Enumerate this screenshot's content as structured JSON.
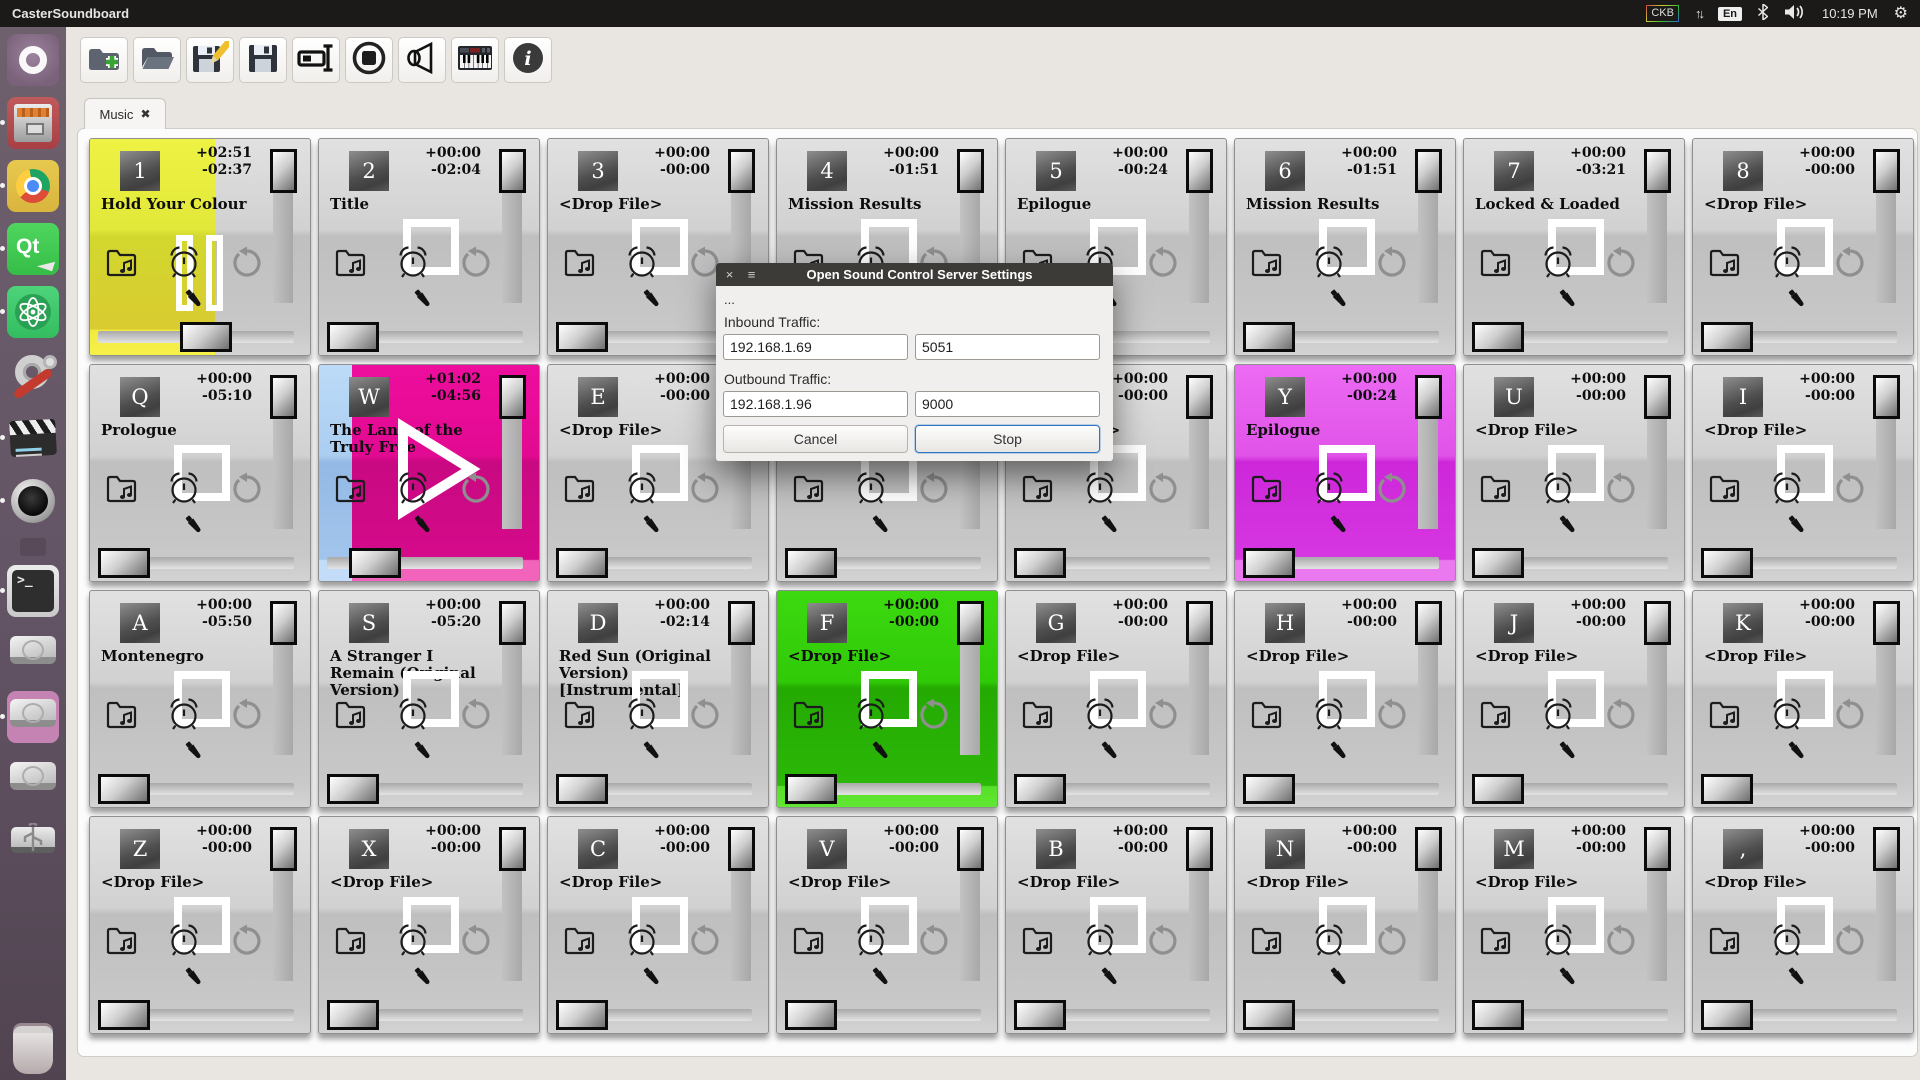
{
  "topbar": {
    "app_title": "CasterSoundboard",
    "kbd_badge": "CKB",
    "lang_badge": "En",
    "clock": "10:19 PM"
  },
  "launcher": {
    "items": [
      {
        "name": "ubuntu-dash",
        "dot": false
      },
      {
        "name": "file-cabinet",
        "dot": true
      },
      {
        "name": "chrome-browser",
        "dot": true
      },
      {
        "name": "qt-creator",
        "dot": true
      },
      {
        "name": "atom-editor",
        "dot": true
      },
      {
        "name": "system-tools",
        "dot": false
      },
      {
        "name": "video-editor",
        "dot": true
      },
      {
        "name": "speaker-app",
        "dot": true
      },
      {
        "name": "mini-indicator",
        "dot": false
      },
      {
        "name": "terminal",
        "dot": true
      },
      {
        "name": "hard-drive-1",
        "dot": false
      },
      {
        "name": "hard-drive-mounted",
        "dot": true
      },
      {
        "name": "hard-drive-2",
        "dot": false
      },
      {
        "name": "usb-drive",
        "dot": false
      },
      {
        "name": "trash",
        "dot": false
      }
    ]
  },
  "toolbar": {
    "buttons": [
      {
        "name": "new-soundboard"
      },
      {
        "name": "open-soundboard"
      },
      {
        "name": "save-soundboard-as"
      },
      {
        "name": "save-soundboard"
      },
      {
        "name": "rename-board"
      },
      {
        "name": "stop-all-sounds"
      },
      {
        "name": "audio-output"
      },
      {
        "name": "midi-keyboard"
      },
      {
        "name": "about-info"
      }
    ]
  },
  "tabbar": {
    "tabs": [
      {
        "label": "Music",
        "close_glyph": "✖"
      }
    ]
  },
  "colors": {
    "pad_yellow": "#e8ee3a",
    "pad_magenta": "#e0098e",
    "pad_violet": "#d93ae3",
    "pad_green": "#2ec607",
    "fill_blue": "#a9cbf0",
    "dialog_titlebar": "#3c3b37",
    "accent_blue": "#2f76c0"
  },
  "board": {
    "pads": [
      {
        "key": "1",
        "title": "Hold Your Colour",
        "elapsed": "+02:51",
        "remaining": "-02:37",
        "state": "pause",
        "base": "gray",
        "fill": "yellow",
        "fill_pct": 57
      },
      {
        "key": "2",
        "title": "Title",
        "elapsed": "+00:00",
        "remaining": "-02:04",
        "state": "square",
        "base": "gray",
        "fill": "none",
        "fill_pct": 0
      },
      {
        "key": "3",
        "title": "<Drop File>",
        "elapsed": "+00:00",
        "remaining": "-00:00",
        "state": "square",
        "base": "gray",
        "fill": "none",
        "fill_pct": 0
      },
      {
        "key": "4",
        "title": "Mission Results",
        "elapsed": "+00:00",
        "remaining": "-01:51",
        "state": "square",
        "base": "gray",
        "fill": "none",
        "fill_pct": 0
      },
      {
        "key": "5",
        "title": "Epilogue",
        "elapsed": "+00:00",
        "remaining": "-00:24",
        "state": "square",
        "base": "gray",
        "fill": "none",
        "fill_pct": 0
      },
      {
        "key": "6",
        "title": "Mission Results",
        "elapsed": "+00:00",
        "remaining": "-01:51",
        "state": "square",
        "base": "gray",
        "fill": "none",
        "fill_pct": 0
      },
      {
        "key": "7",
        "title": "Locked & Loaded",
        "elapsed": "+00:00",
        "remaining": "-03:21",
        "state": "square",
        "base": "gray",
        "fill": "none",
        "fill_pct": 0
      },
      {
        "key": "8",
        "title": "<Drop File>",
        "elapsed": "+00:00",
        "remaining": "-00:00",
        "state": "square",
        "base": "gray",
        "fill": "none",
        "fill_pct": 0
      },
      {
        "key": "Q",
        "title": "Prologue",
        "elapsed": "+00:00",
        "remaining": "-05:10",
        "state": "square",
        "base": "gray",
        "fill": "none",
        "fill_pct": 0
      },
      {
        "key": "W",
        "title": "The Land of the Truly Free",
        "elapsed": "+01:02",
        "remaining": "-04:56",
        "state": "play",
        "base": "magenta",
        "fill": "blue",
        "fill_pct": 15
      },
      {
        "key": "E",
        "title": "<Drop File>",
        "elapsed": "+00:00",
        "remaining": "-00:00",
        "state": "square",
        "base": "gray",
        "fill": "none",
        "fill_pct": 0
      },
      {
        "key": "R",
        "title": "<Drop File>",
        "elapsed": "+00:00",
        "remaining": "-00:00",
        "state": "square",
        "base": "gray",
        "fill": "none",
        "fill_pct": 0
      },
      {
        "key": "T",
        "title": "<Drop File>",
        "elapsed": "+00:00",
        "remaining": "-00:00",
        "state": "square",
        "base": "gray",
        "fill": "none",
        "fill_pct": 0
      },
      {
        "key": "Y",
        "title": "Epilogue",
        "elapsed": "+00:00",
        "remaining": "-00:24",
        "state": "square",
        "base": "violet",
        "fill": "none",
        "fill_pct": 0
      },
      {
        "key": "U",
        "title": "<Drop File>",
        "elapsed": "+00:00",
        "remaining": "-00:00",
        "state": "square",
        "base": "gray",
        "fill": "none",
        "fill_pct": 0
      },
      {
        "key": "I",
        "title": "<Drop File>",
        "elapsed": "+00:00",
        "remaining": "-00:00",
        "state": "square",
        "base": "gray",
        "fill": "none",
        "fill_pct": 0
      },
      {
        "key": "A",
        "title": "Montenegro",
        "elapsed": "+00:00",
        "remaining": "-05:50",
        "state": "square",
        "base": "gray",
        "fill": "none",
        "fill_pct": 0
      },
      {
        "key": "S",
        "title": "A Stranger I Remain (Original Version)",
        "elapsed": "+00:00",
        "remaining": "-05:20",
        "state": "square",
        "base": "gray",
        "fill": "none",
        "fill_pct": 0
      },
      {
        "key": "D",
        "title": "Red Sun (Original Version) [Instrumental]",
        "elapsed": "+00:00",
        "remaining": "-02:14",
        "state": "square",
        "base": "gray",
        "fill": "none",
        "fill_pct": 0
      },
      {
        "key": "F",
        "title": "<Drop File>",
        "elapsed": "+00:00",
        "remaining": "-00:00",
        "state": "square",
        "base": "green",
        "fill": "none",
        "fill_pct": 0
      },
      {
        "key": "G",
        "title": "<Drop File>",
        "elapsed": "+00:00",
        "remaining": "-00:00",
        "state": "square",
        "base": "gray",
        "fill": "none",
        "fill_pct": 0
      },
      {
        "key": "H",
        "title": "<Drop File>",
        "elapsed": "+00:00",
        "remaining": "-00:00",
        "state": "square",
        "base": "gray",
        "fill": "none",
        "fill_pct": 0
      },
      {
        "key": "J",
        "title": "<Drop File>",
        "elapsed": "+00:00",
        "remaining": "-00:00",
        "state": "square",
        "base": "gray",
        "fill": "none",
        "fill_pct": 0
      },
      {
        "key": "K",
        "title": "<Drop File>",
        "elapsed": "+00:00",
        "remaining": "-00:00",
        "state": "square",
        "base": "gray",
        "fill": "none",
        "fill_pct": 0
      },
      {
        "key": "Z",
        "title": "<Drop File>",
        "elapsed": "+00:00",
        "remaining": "-00:00",
        "state": "square",
        "base": "gray",
        "fill": "none",
        "fill_pct": 0
      },
      {
        "key": "X",
        "title": "<Drop File>",
        "elapsed": "+00:00",
        "remaining": "-00:00",
        "state": "square",
        "base": "gray",
        "fill": "none",
        "fill_pct": 0
      },
      {
        "key": "C",
        "title": "<Drop File>",
        "elapsed": "+00:00",
        "remaining": "-00:00",
        "state": "square",
        "base": "gray",
        "fill": "none",
        "fill_pct": 0
      },
      {
        "key": "V",
        "title": "<Drop File>",
        "elapsed": "+00:00",
        "remaining": "-00:00",
        "state": "square",
        "base": "gray",
        "fill": "none",
        "fill_pct": 0
      },
      {
        "key": "B",
        "title": "<Drop File>",
        "elapsed": "+00:00",
        "remaining": "-00:00",
        "state": "square",
        "base": "gray",
        "fill": "none",
        "fill_pct": 0
      },
      {
        "key": "N",
        "title": "<Drop File>",
        "elapsed": "+00:00",
        "remaining": "-00:00",
        "state": "square",
        "base": "gray",
        "fill": "none",
        "fill_pct": 0
      },
      {
        "key": "M",
        "title": "<Drop File>",
        "elapsed": "+00:00",
        "remaining": "-00:00",
        "state": "square",
        "base": "gray",
        "fill": "none",
        "fill_pct": 0
      },
      {
        "key": ",",
        "title": "<Drop File>",
        "elapsed": "+00:00",
        "remaining": "-00:00",
        "state": "square",
        "base": "gray",
        "fill": "none",
        "fill_pct": 0
      }
    ]
  },
  "dialog": {
    "title": "Open Sound Control Server Settings",
    "close_glyph": "×",
    "menu_glyph": "≡",
    "note": "...",
    "inbound_label": "Inbound Traffic:",
    "inbound_ip": "192.168.1.69",
    "inbound_port": "5051",
    "outbound_label": "Outbound Traffic:",
    "outbound_ip": "192.168.1.96",
    "outbound_port": "9000",
    "cancel_label": "Cancel",
    "stop_label": "Stop"
  }
}
